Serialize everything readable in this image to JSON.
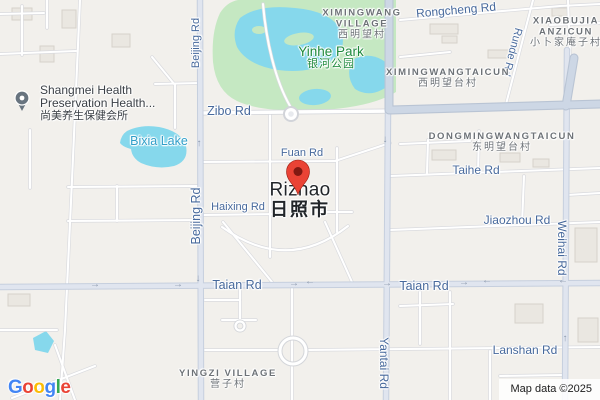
{
  "attribution": "Map data ©2025",
  "google_logo": {
    "g1": "G",
    "o1": "o",
    "o2": "o",
    "g2": "g",
    "l1": "l",
    "e1": "e"
  },
  "city": {
    "name": "Rizhao",
    "name_zh": "日照市"
  },
  "poi_shangmei": {
    "line1": "Shangmei Health",
    "line2": "Preservation Health...",
    "zh": "尚美养生保健会所"
  },
  "park_yinhe": {
    "name": "Yinhe Park",
    "zh": "银河公园"
  },
  "lake_bixia": {
    "name": "Bixia Lake"
  },
  "villages": {
    "ximingwang": {
      "l1": "XIMINGWANG",
      "l2": "VILLAGE",
      "zh": "西明望村"
    },
    "xiaobujia": {
      "l1": "XIAOBUJIA",
      "l2": "ANZICUN",
      "zh": "小卜家庵子村"
    },
    "ximingwangtaicun": {
      "l1": "XIMINGWANGTAICUN",
      "zh": "西明望台村"
    },
    "dongmingwangtaicun": {
      "l1": "DONGMINGWANGTAICUN",
      "zh": "东明望台村"
    },
    "yingzi": {
      "l1": "YINGZI VILLAGE",
      "zh": "营子村"
    }
  },
  "roads": {
    "rongcheng": "Rongcheng Rd",
    "runde": "Runde Rd",
    "zibo": "Zibo Rd",
    "fuan": "Fuan Rd",
    "haixing": "Haixing Rd",
    "beijing": "Beijing Rd",
    "taihe": "Taihe Rd",
    "jiaozhou": "Jiaozhou Rd",
    "weihai": "Weihai Rd",
    "taian": "Taian Rd",
    "yantai": "Yantai Rd",
    "lanshan": "Lanshan Rd"
  },
  "icons": {
    "arrow_right": "→",
    "arrow_left": "←",
    "arrow_up": "↑",
    "arrow_down": "↓"
  },
  "colors": {
    "background": "#f2f0ec",
    "water": "#86d8ec",
    "park": "#c5e8c2",
    "road_major_fill": "#e0e5ef",
    "highway_fill": "#cdd7e5",
    "road_label": "#47699c",
    "water_label": "#2f9ec8",
    "park_label": "#1f8a3d",
    "village_label": "#6d7277",
    "city_label": "#212529",
    "pin_red": "#EA4335",
    "poi_pin": "#68747f",
    "logo_blue": "#4285F4",
    "logo_red": "#EA4335",
    "logo_yellow": "#FBBC05",
    "logo_green": "#34A853"
  }
}
